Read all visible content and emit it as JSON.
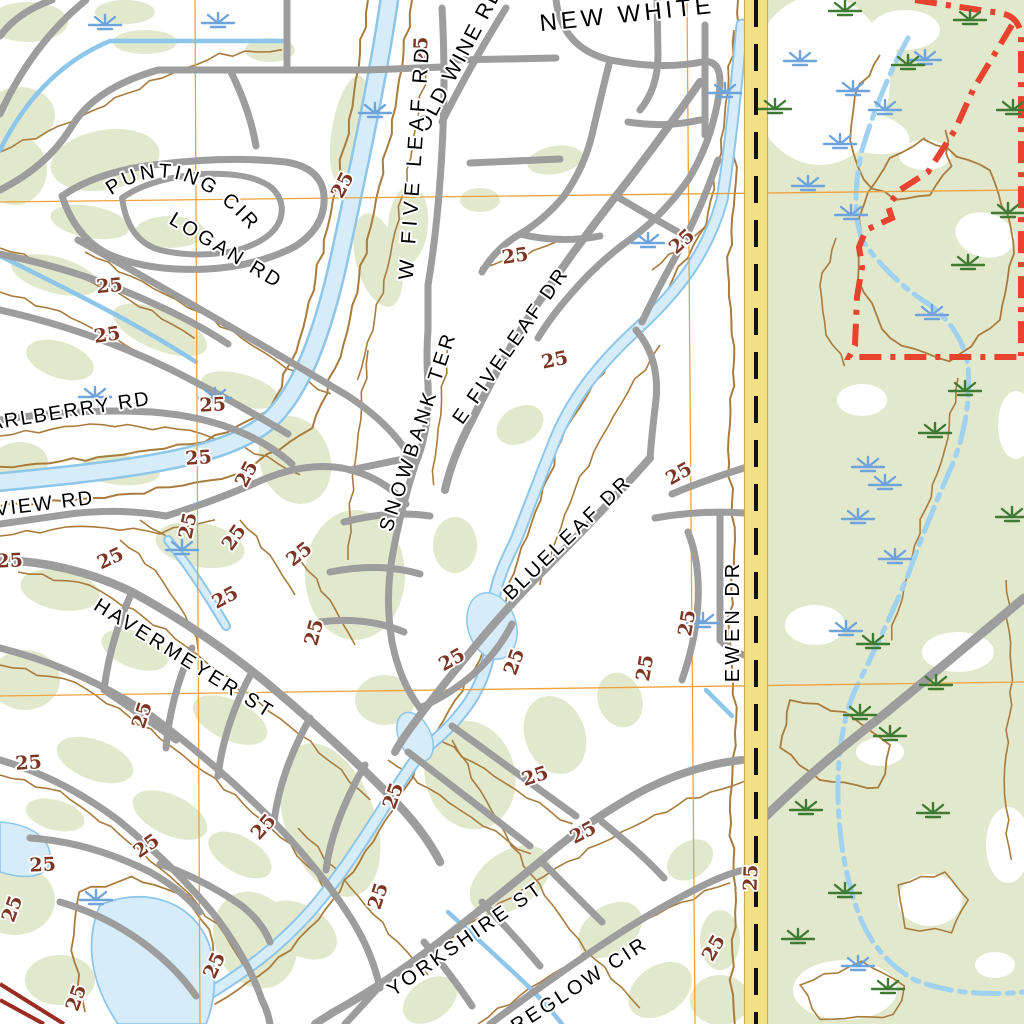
{
  "map": {
    "kind": "usgs-topo-quad-detail",
    "contour_label_text": "25",
    "colors": {
      "vegetation_green": "#e2e8cc",
      "water_fill": "#d6edf9",
      "water_edge": "#8ec6ea",
      "road_gray": "#9d9d9d",
      "contour_brown": "#a87c3f",
      "contour_label_brown": "#7c3423",
      "grid_orange": "#f0a23d",
      "highway_yellow": "#f2e086",
      "highway_centerline": "#111111",
      "boundary_red": "#e8432e",
      "divided_highway_red": "#9b2c23",
      "marsh_blue": "#6ea3dc",
      "marsh_green": "#3f7a33",
      "label_black": "#000000"
    },
    "street_labels": [
      {
        "text": "NEW WHITE",
        "x": 628,
        "y": 22,
        "rot": -6,
        "size": 24,
        "ls": 4
      },
      {
        "text": "OLD WINE RD",
        "x": 465,
        "y": 62,
        "rot": -62,
        "size": 21,
        "ls": 2
      },
      {
        "text": "W FIVE LEAF RD",
        "x": 421,
        "y": 162,
        "rot": -86,
        "size": 21,
        "ls": 5
      },
      {
        "text": "PUNTING CIR",
        "path": "punting-path",
        "size": 20,
        "ls": 3
      },
      {
        "text": "LOGAN RD",
        "x": 223,
        "y": 256,
        "rot": 31,
        "size": 20,
        "ls": 3
      },
      {
        "text": "ARLBERRY RD",
        "x": -10,
        "y": 430,
        "rot": -9,
        "size": 20,
        "ls": 2,
        "anchor": "start"
      },
      {
        "text": "VIEW RD",
        "x": -4,
        "y": 516,
        "rot": -7,
        "size": 20,
        "ls": 2,
        "anchor": "start"
      },
      {
        "text": "SNOWBANK TER",
        "x": 424,
        "y": 433,
        "rot": -72,
        "size": 20,
        "ls": 4
      },
      {
        "text": "E FIVELEAF DR",
        "x": 516,
        "y": 349,
        "rot": -55,
        "size": 20,
        "ls": 3
      },
      {
        "text": "BLUELEAF DR",
        "x": 572,
        "y": 542,
        "rot": -44,
        "size": 20,
        "ls": 3
      },
      {
        "text": "HAVERMEYER ST",
        "x": 181,
        "y": 664,
        "rot": 32,
        "size": 20,
        "ls": 3
      },
      {
        "text": "EWEN DR",
        "x": 739,
        "y": 621,
        "rot": -90,
        "size": 20,
        "ls": 4
      },
      {
        "text": "YORKSHIRE ST",
        "x": 469,
        "y": 944,
        "rot": -35,
        "size": 20,
        "ls": 3
      },
      {
        "text": "REGLOW CIR",
        "x": 583,
        "y": 990,
        "rot": -33,
        "size": 20,
        "ls": 3
      }
    ],
    "contour_labels": [
      {
        "x": 427,
        "y": 50,
        "r": -88
      },
      {
        "x": 348,
        "y": 188,
        "r": -62
      },
      {
        "x": 516,
        "y": 262,
        "r": -8
      },
      {
        "x": 686,
        "y": 246,
        "r": -42
      },
      {
        "x": 556,
        "y": 366,
        "r": -12
      },
      {
        "x": 110,
        "y": 292,
        "r": -5
      },
      {
        "x": 108,
        "y": 341,
        "r": -8
      },
      {
        "x": 213,
        "y": 411,
        "r": -3
      },
      {
        "x": 199,
        "y": 464,
        "r": -4
      },
      {
        "x": 252,
        "y": 477,
        "r": -62
      },
      {
        "x": 194,
        "y": 527,
        "r": -78
      },
      {
        "x": 239,
        "y": 541,
        "r": -55
      },
      {
        "x": 10,
        "y": 567,
        "r": -3
      },
      {
        "x": 113,
        "y": 564,
        "r": -25
      },
      {
        "x": 303,
        "y": 559,
        "r": -38
      },
      {
        "x": 320,
        "y": 634,
        "r": -75
      },
      {
        "x": 228,
        "y": 603,
        "r": -28
      },
      {
        "x": 148,
        "y": 717,
        "r": -72
      },
      {
        "x": 29,
        "y": 769,
        "r": -4
      },
      {
        "x": 150,
        "y": 851,
        "r": -35
      },
      {
        "x": 43,
        "y": 871,
        "r": -3
      },
      {
        "x": 18,
        "y": 911,
        "r": -70
      },
      {
        "x": 268,
        "y": 831,
        "r": -48
      },
      {
        "x": 220,
        "y": 968,
        "r": -65
      },
      {
        "x": 82,
        "y": 1000,
        "r": -70
      },
      {
        "x": 537,
        "y": 782,
        "r": -18
      },
      {
        "x": 586,
        "y": 838,
        "r": -28
      },
      {
        "x": 399,
        "y": 798,
        "r": -70
      },
      {
        "x": 384,
        "y": 898,
        "r": -72
      },
      {
        "x": 757,
        "y": 878,
        "r": -88
      },
      {
        "x": 455,
        "y": 665,
        "r": -30
      },
      {
        "x": 520,
        "y": 664,
        "r": -70
      },
      {
        "x": 651,
        "y": 669,
        "r": -80
      },
      {
        "x": 693,
        "y": 624,
        "r": -80
      },
      {
        "x": 682,
        "y": 479,
        "r": -30
      },
      {
        "x": 719,
        "y": 951,
        "r": -60
      }
    ],
    "marsh_symbols": {
      "blue": [
        [
          105,
          22
        ],
        [
          218,
          20
        ],
        [
          375,
          110
        ],
        [
          95,
          394
        ],
        [
          215,
          395
        ],
        [
          96,
          897
        ],
        [
          703,
          620
        ],
        [
          725,
          90
        ],
        [
          648,
          240
        ],
        [
          182,
          547
        ],
        [
          800,
          58
        ],
        [
          853,
          88
        ],
        [
          885,
          107
        ],
        [
          840,
          141
        ],
        [
          808,
          183
        ],
        [
          851,
          212
        ],
        [
          925,
          57
        ],
        [
          932,
          312
        ],
        [
          868,
          464
        ],
        [
          885,
          482
        ],
        [
          858,
          516
        ],
        [
          895,
          556
        ],
        [
          858,
          963
        ],
        [
          846,
          628
        ]
      ],
      "green": [
        [
          970,
          17
        ],
        [
          845,
          8
        ],
        [
          775,
          106
        ],
        [
          908,
          62
        ],
        [
          1013,
          107
        ],
        [
          1008,
          210
        ],
        [
          965,
          388
        ],
        [
          935,
          430
        ],
        [
          1012,
          514
        ],
        [
          936,
          682
        ],
        [
          890,
          733
        ],
        [
          860,
          712
        ],
        [
          806,
          807
        ],
        [
          873,
          641
        ],
        [
          933,
          810
        ],
        [
          845,
          890
        ],
        [
          888,
          986
        ],
        [
          798,
          936
        ],
        [
          968,
          262
        ]
      ]
    }
  }
}
